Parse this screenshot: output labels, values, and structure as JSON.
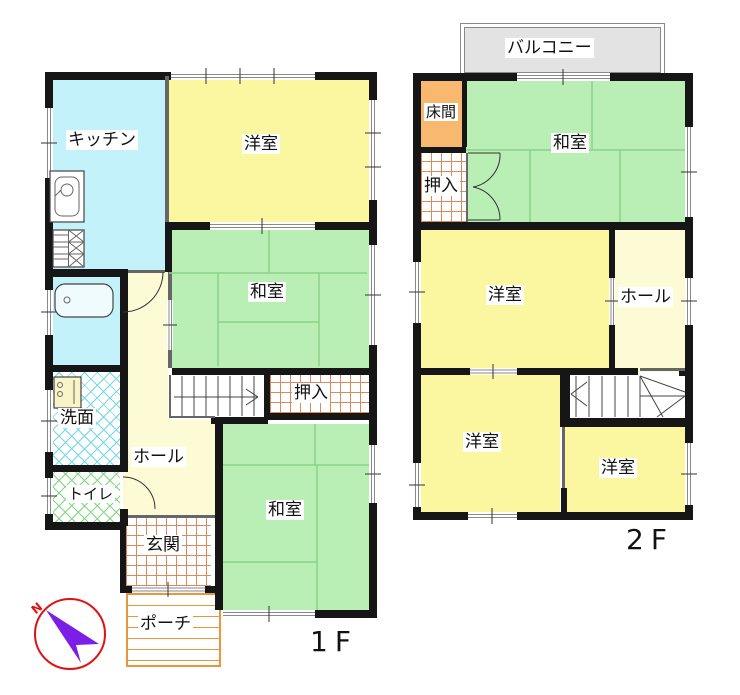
{
  "plan": {
    "floor_1f": {
      "label": "1F",
      "rooms": {
        "kitchen": "キッチン",
        "western_room": "洋室",
        "japanese_room_middle": "和室",
        "japanese_room_bottom": "和室",
        "closet": "押入",
        "washroom": "洗面",
        "toilet": "トイレ",
        "hall": "ホール",
        "entrance": "玄関",
        "porch": "ポーチ"
      }
    },
    "floor_2f": {
      "label": "2F",
      "rooms": {
        "balcony": "バルコニー",
        "tokonoma": "床間",
        "closet": "押入",
        "japanese_room": "和室",
        "western_room_center": "洋室",
        "hall": "ホール",
        "western_room_bottom_left": "洋室",
        "western_room_bottom_right": "洋室"
      }
    },
    "compass": {
      "north": "N"
    }
  },
  "colors": {
    "kitchen_cyan": "#c4f2fa",
    "room_yellow": "#fbf6a0",
    "room_green": "#b9eeb5",
    "hall_cream": "#fdfad6",
    "tokonoma_orange": "#f8b870",
    "balcony_gray": "#e3e3e3",
    "wall_black": "#161616",
    "grid_orange": "#d98b5d",
    "porch_orange": "#e8963c",
    "hatch_cyan": "#6fd8e6",
    "hatch_green": "#7ed87e",
    "tatami_green": "#8ad08a",
    "compass_red": "#e01212",
    "compass_purple": "#7a1ee8"
  }
}
